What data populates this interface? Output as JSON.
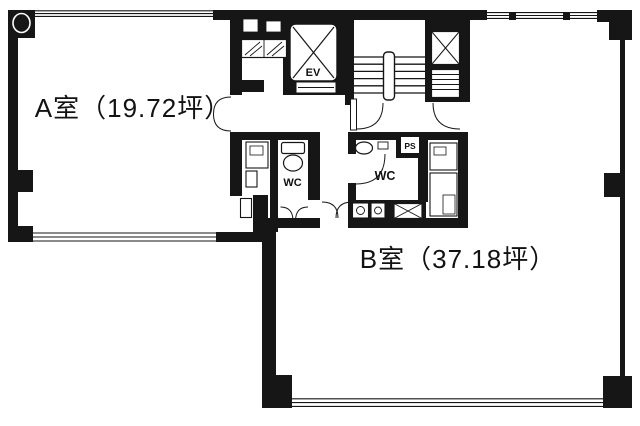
{
  "page": {
    "background": "#ffffff"
  },
  "plan": {
    "wall_color": "#161616",
    "line_color": "#161616",
    "room_a": {
      "label": "A室（19.72坪）",
      "name": "A室",
      "area_tsubo": "19.72坪"
    },
    "room_b": {
      "label": "B室（37.18坪）",
      "name": "B室",
      "area_tsubo": "37.18坪"
    },
    "elevator_label": "EV",
    "wc_left_label": "WC",
    "wc_right_label": "WC",
    "pipe_space_label": "PS"
  }
}
